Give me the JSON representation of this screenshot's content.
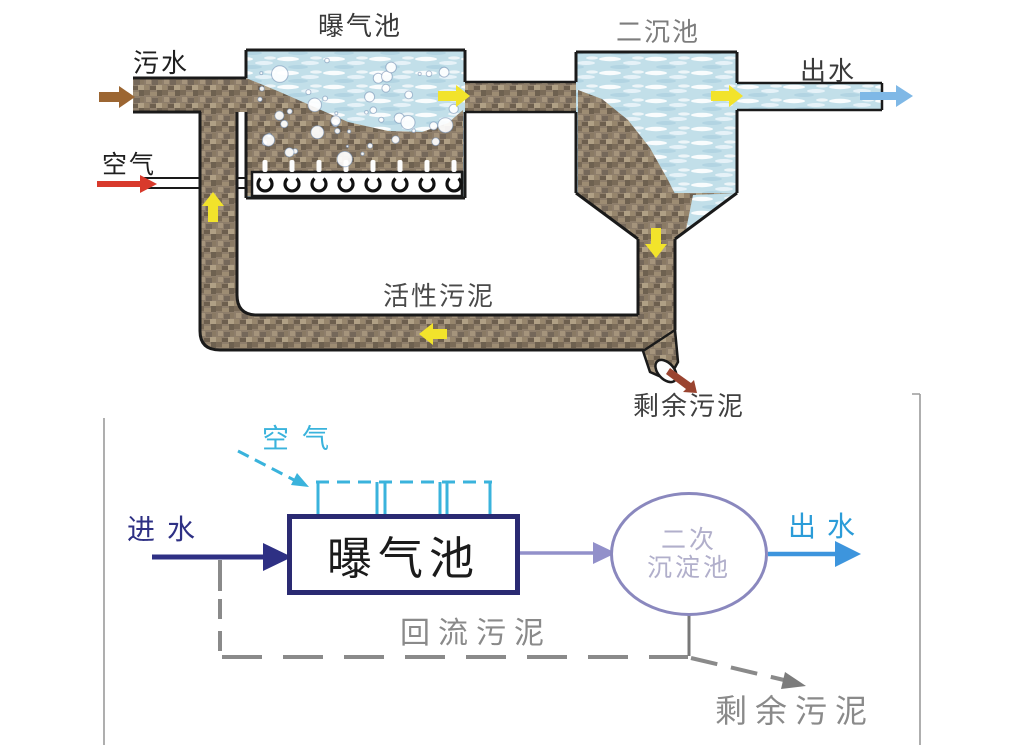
{
  "canvas": {
    "width": 1009,
    "height": 745,
    "background": "#ffffff"
  },
  "top_diagram": {
    "description": "activated-sludge-process-illustration",
    "labels": {
      "aeration_tank": "曝气池",
      "secondary_clarifier": "二沉池",
      "influent": "污水",
      "effluent": "出水",
      "air": "空气",
      "activated_sludge": "活性污泥",
      "excess_sludge": "剩余污泥"
    },
    "colors": {
      "sludge_base": "#8e7e6b",
      "water_base": "#c2dfe9",
      "outline": "#1a1a1a",
      "flow_arrow_yellow": "#f2e32b",
      "influent_arrow_brown": "#9c6632",
      "air_arrow_red": "#d83a2c",
      "effluent_arrow_blue": "#7fb8e6",
      "excess_sludge_arrow_brown": "#9a4430",
      "label_dark": "#2a2a2a",
      "label_gray": "#7d7d7d"
    }
  },
  "bottom_diagram": {
    "description": "activated-sludge-process-flowchart",
    "labels": {
      "influent": "进水",
      "air": "空气",
      "aeration_tank": "曝气池",
      "secondary_clarifier_line1": "二次",
      "secondary_clarifier_line2": "沉淀池",
      "effluent": "出水",
      "return_sludge": "回流污泥",
      "excess_sludge": "剩余污泥"
    },
    "colors": {
      "influent": "#2e3084",
      "air_cyan": "#3ab3dc",
      "box_border": "#2a2a72",
      "box_text": "#1b1b1b",
      "link_arrow_purple": "#9290ca",
      "circle_border": "#8a88be",
      "circle_text": "#b1afcb",
      "effluent_text": "#2b9cd8",
      "effluent_arrow": "#3d95dd",
      "sludge_gray": "#8a8a8a",
      "frame_gray": "#9b9b9b"
    }
  }
}
